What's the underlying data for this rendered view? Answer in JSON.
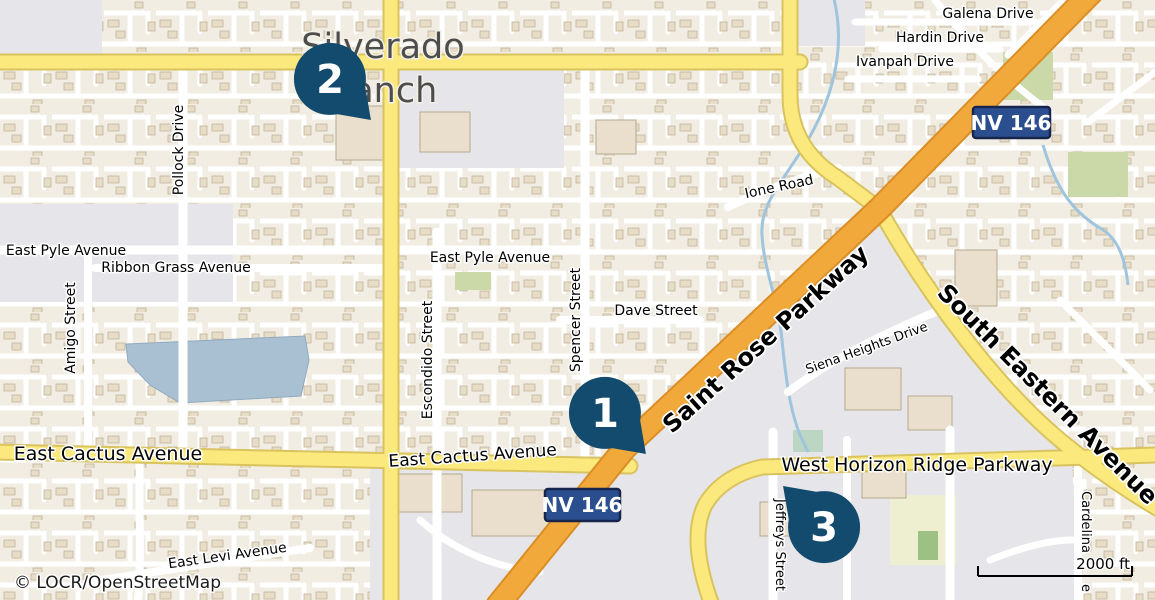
{
  "map": {
    "attribution": "© LOCR/OpenStreetMap",
    "scale_label": "2000 ft",
    "shield_label": "NV 146",
    "markers": [
      {
        "number": "1"
      },
      {
        "number": "2"
      },
      {
        "number": "3"
      }
    ],
    "labels": {
      "place_line1": "Silverado",
      "place_line2": "Ranch",
      "galena": "Galena Drive",
      "hardin": "Hardin Drive",
      "ivanpah": "Ivanpah Drive",
      "ione": "Ione Road",
      "east_pyle_w": "East Pyle Avenue",
      "east_pyle_e": "East Pyle Avenue",
      "ribbon_grass": "Ribbon Grass Avenue",
      "amigo": "Amigo Street",
      "pollock": "Pollock Drive",
      "escondido": "Escondido Street",
      "spencer": "Spencer Street",
      "dave": "Dave Street",
      "saint_rose": "Saint Rose Parkway",
      "south_eastern": "South Eastern Avenue",
      "cactus_w": "East Cactus Avenue",
      "cactus_e": "East Cactus Avenue",
      "horizon": "West Horizon Ridge Parkway",
      "siena": "Siena Heights Drive",
      "jeffreys": "Jeffreys Street",
      "cardelina": "Cardelina",
      "cardelina_tail": "e",
      "levi": "East Levi Avenue"
    },
    "colors": {
      "land": "#F1EDE3",
      "commercial_gray": "#E6E5E9",
      "water": "#A9C0D3",
      "road_yellow": "#FBE97E",
      "road_orange": "#F2A93C",
      "road_white": "#FFFFFF",
      "park_green": "#CBD8A8",
      "field_green": "#EDEFD0",
      "marker_navy": "#134B6E",
      "shield_blue": "#2B4E8F",
      "stream_blue": "#9FC4DE",
      "building_tan": "#E9DFCC"
    }
  }
}
